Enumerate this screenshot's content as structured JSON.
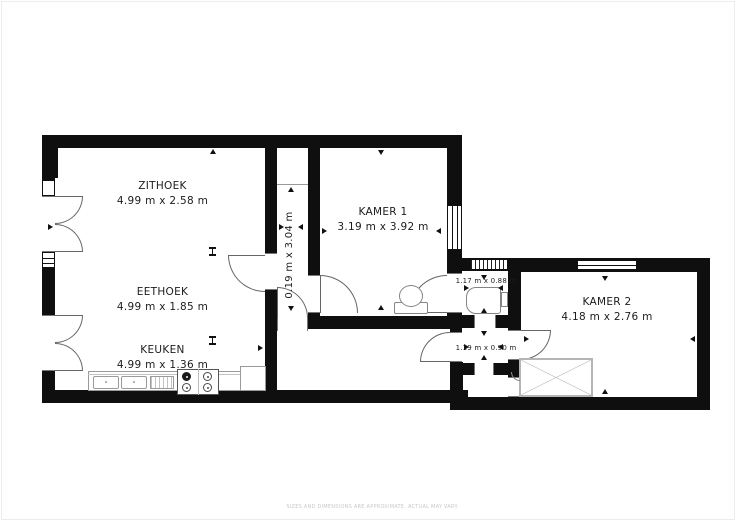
{
  "floorplan": {
    "rooms": {
      "zithoek": {
        "name": "ZITHOEK",
        "size": "4.99 m x 2.58 m"
      },
      "eethoek": {
        "name": "EETHOEK",
        "size": "4.99 m x 1.85 m"
      },
      "keuken": {
        "name": "KEUKEN",
        "size": "4.99 m x 1.36 m"
      },
      "kamer1": {
        "name": "KAMER 1",
        "size": "3.19 m x 3.92 m"
      },
      "kamer2": {
        "name": "KAMER 2",
        "size": "4.18 m x 2.76 m"
      },
      "hal": {
        "size": "0.19 m x 3.04 m"
      },
      "badkamer": {
        "size": "1.17 m x 0.88 m"
      },
      "gang": {
        "size": "1.19 m x 0.90 m"
      }
    },
    "disclaimer": "SIZES AND DIMENSIONS ARE APPROXIMATE. ACTUAL MAY VARY.",
    "colors": {
      "wall": "#0f0f0f",
      "background": "#ffffff",
      "fixture": "#848484",
      "counter": "#9a9a9a"
    },
    "fixtures": [
      "toilet",
      "bathtub",
      "kitchen-sink",
      "stove",
      "wardrobe"
    ]
  }
}
